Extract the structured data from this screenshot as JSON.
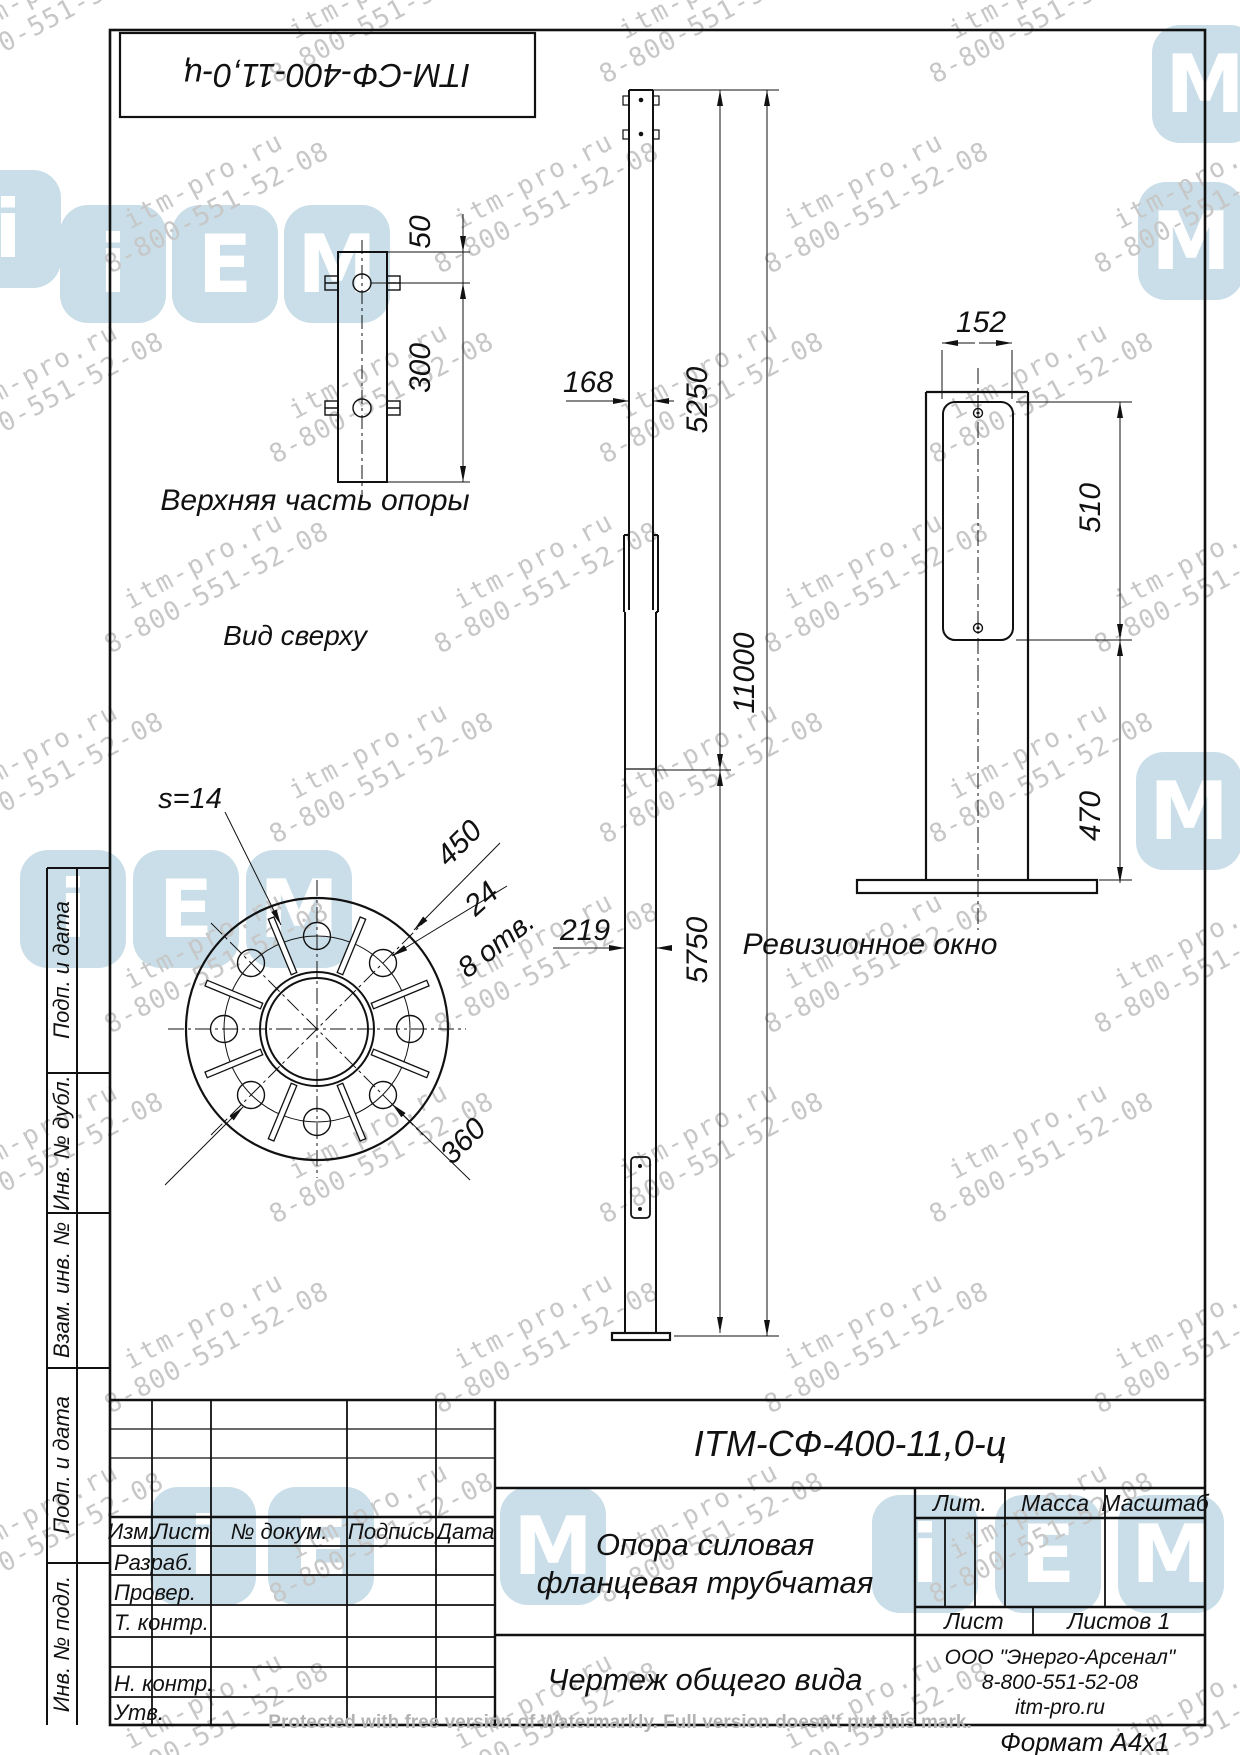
{
  "page": {
    "designation_top": "ITM-СФ-400-11,0-ц",
    "protected_note": "Protected with free version of Watermarkly. Full version doesn't put this mark.",
    "format_label": "Формат  А4х1"
  },
  "watermark": {
    "line1": "itm-pro.ru",
    "line2": "8-800-551-52-08",
    "logo_letters": [
      "i",
      "Е",
      "М"
    ],
    "text_color": "#c7c7c7",
    "logo_color": "#c9dee8"
  },
  "views": {
    "top_part": {
      "label": "Верхняя часть опоры",
      "dims": {
        "d50": "50",
        "d300": "300"
      }
    },
    "top_view": {
      "label": "Вид сверху",
      "dims": {
        "s": "s=14",
        "d450": "450",
        "d24": "24",
        "holes": "8 отв.",
        "d360": "360"
      }
    },
    "front": {
      "dims": {
        "d168": "168",
        "d5250": "5250",
        "d11000": "11000",
        "d219": "219",
        "d5750": "5750"
      }
    },
    "window": {
      "label": "Ревизионное окно",
      "dims": {
        "d152": "152",
        "d510": "510",
        "d470": "470"
      }
    }
  },
  "stamp": {
    "designation": "ITM-СФ-400-11,0-ц",
    "title_line1": "Опора силовая",
    "title_line2": "фланцевая  трубчатая",
    "doc_type": "Чертеж общего вида",
    "company_line1": "ООО \"Энерго-Арсенал\"",
    "company_line2": "8-800-551-52-08",
    "company_line3": "itm-pro.ru",
    "header": {
      "izm": "Изм.",
      "list": "Лист",
      "doc": "№ докум.",
      "sign": "Подпись",
      "date": "Дата"
    },
    "rows": [
      "Разраб.",
      "Провер.",
      "Т. контр.",
      "",
      "Н. контр.",
      "Утв."
    ],
    "lit": "Лит.",
    "massa": "Масса",
    "scale": "Масштаб",
    "sheet": "Лист",
    "sheets": "Листов 1"
  },
  "side_column": {
    "cells": [
      "Подп. и дата",
      "Инв. № дубл.",
      "Взам. инв. №",
      "Подп. и дата",
      "Инв. № подл."
    ]
  }
}
